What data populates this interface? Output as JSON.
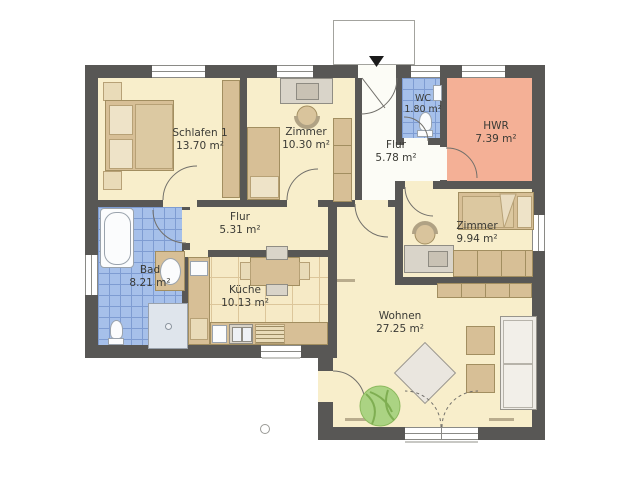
{
  "plan_title": "floor-plan",
  "rooms": [
    {
      "id": "schlafen1",
      "name": "Schlafen 1",
      "area": "13.70 m²"
    },
    {
      "id": "zimmer1",
      "name": "Zimmer",
      "area": "10.30 m²"
    },
    {
      "id": "flur-entry",
      "name": "Flur",
      "area": "5.78 m²"
    },
    {
      "id": "wc",
      "name": "WC",
      "area": "1.80 m²"
    },
    {
      "id": "hwr",
      "name": "HWR",
      "area": "7.39 m²"
    },
    {
      "id": "zimmer2",
      "name": "Zimmer",
      "area": "9.94 m²"
    },
    {
      "id": "flur",
      "name": "Flur",
      "area": "5.31 m²"
    },
    {
      "id": "bad",
      "name": "Bad",
      "area": "8.21 m²"
    },
    {
      "id": "kueche",
      "name": "Küche",
      "area": "10.13 m²"
    },
    {
      "id": "wohnen",
      "name": "Wohnen",
      "area": "27.25 m²"
    }
  ],
  "colors": {
    "wall": "#585755",
    "cream": "#f8eecb",
    "hall": "#fcfcf6",
    "tile-blue": "#a6c0ea",
    "grout": "#7e9cd2",
    "salmon": "#f4b096",
    "tan": "#d7bf96",
    "tan-dark": "#a28e60",
    "tan-light": "#e9dbb8",
    "grayf": "#d9d4c9",
    "whitef": "#fbfcfd",
    "text": "#3a3a35"
  }
}
